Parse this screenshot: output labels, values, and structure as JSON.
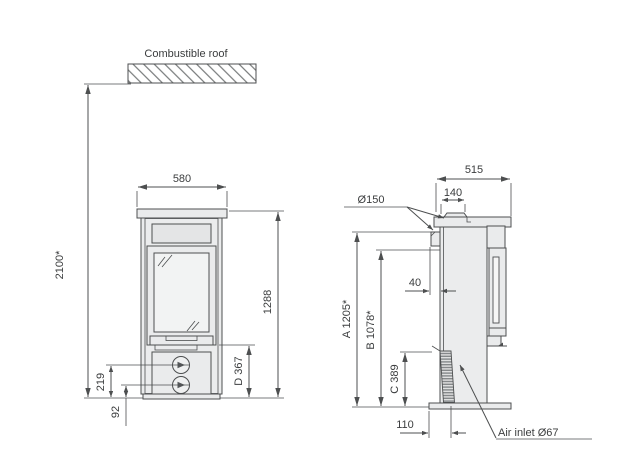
{
  "style": {
    "background": "#ffffff",
    "line_color": "#4d4f50",
    "text_color": "#3b3d3e",
    "body_fill": "#eaebec",
    "glass_fill": "#f2f3f3",
    "hatch_color": "#6a6d6e"
  },
  "labels": {
    "roof": "Combustible roof",
    "air_inlet": "Air inlet Ø67"
  },
  "front_view": {
    "width": "580",
    "ceiling_clearance": "2100*",
    "body_height": "1288",
    "dim_d": "D 367",
    "upper_knob_height": "219",
    "lower_knob_height": "92"
  },
  "side_view": {
    "depth": "515",
    "flue_center_from_rear": "140",
    "flue_diameter": "Ø150",
    "rear_clearance": "40",
    "dim_a": "A 1205*",
    "dim_b": "B 1078*",
    "dim_c": "C 389",
    "air_inlet_from_rear": "110"
  }
}
